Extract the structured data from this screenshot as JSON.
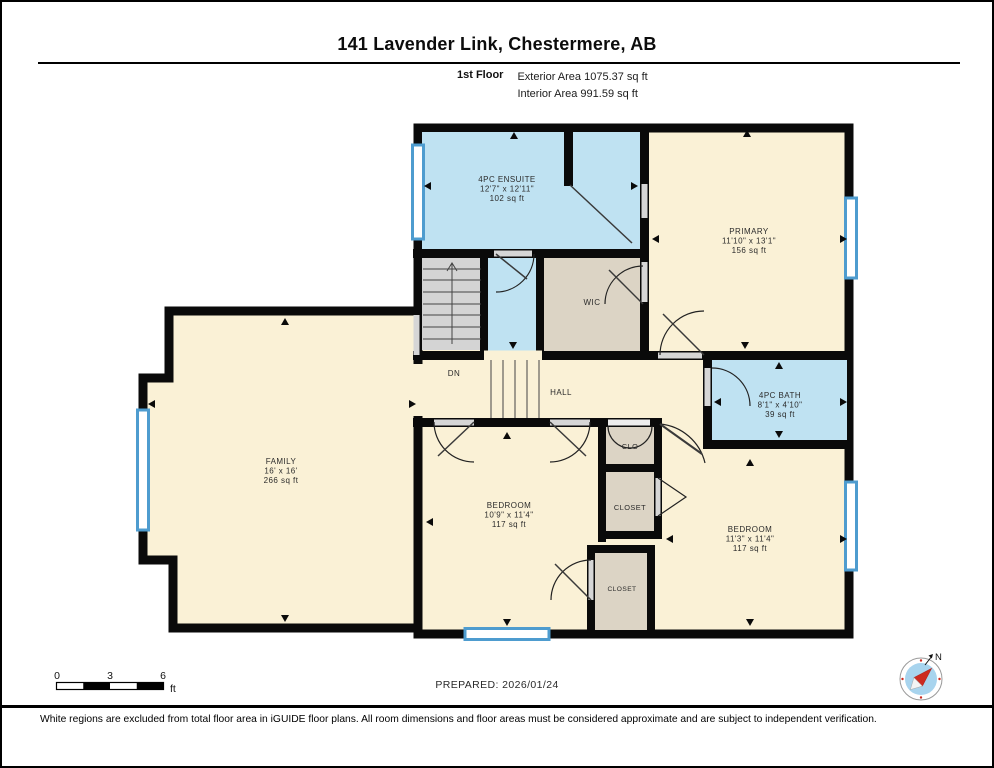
{
  "header": {
    "title": "141 Lavender Link, Chestermere, AB",
    "floor_label": "1st Floor",
    "exterior_area": "Exterior Area 1075.37 sq ft",
    "interior_area": "Interior Area 991.59 sq ft"
  },
  "rooms": {
    "ensuite": {
      "name": "4PC ENSUITE",
      "dims": "12'7\" x 12'11\"",
      "area": "102 sq ft"
    },
    "primary": {
      "name": "PRIMARY",
      "dims": "11'10\" x 13'1\"",
      "area": "156 sq ft"
    },
    "wic": {
      "name": "WIC"
    },
    "hall": {
      "name": "HALL"
    },
    "stairs_dn": {
      "name": "DN"
    },
    "bath": {
      "name": "4PC BATH",
      "dims": "8'1\" x 4'10\"",
      "area": "39 sq ft"
    },
    "family": {
      "name": "FAMILY",
      "dims": "16' x 16'",
      "area": "266 sq ft"
    },
    "bedroom_center": {
      "name": "BEDROOM",
      "dims": "10'9\" x 11'4\"",
      "area": "117 sq ft"
    },
    "bedroom_right": {
      "name": "BEDROOM",
      "dims": "11'3\" x 11'4\"",
      "area": "117 sq ft"
    },
    "clo": {
      "name": "CLO"
    },
    "closet_mid": {
      "name": "CLOSET"
    },
    "closet_bottom": {
      "name": "CLOSET"
    }
  },
  "footer": {
    "scale_bar": {
      "ticks": [
        "0",
        "3",
        "6"
      ],
      "unit": "ft"
    },
    "prepared": "PREPARED: 2026/01/24",
    "compass_label": "N",
    "disclaimer": "White regions are excluded from total floor area in iGUIDE floor plans. All room dimensions and floor areas must be considered approximate and are subject to independent verification."
  },
  "colors": {
    "room_fill": "#FAF1D6",
    "wet_room_fill": "#BFE2F2",
    "closet_fill": "#DCD4C5",
    "stairs_fill": "#D4D4D4",
    "wall_black": "#0A0A0A",
    "window_blue": "#4E9CCF",
    "compass_inner": "#A8D4EE",
    "compass_needle_red": "#CC2A20"
  }
}
